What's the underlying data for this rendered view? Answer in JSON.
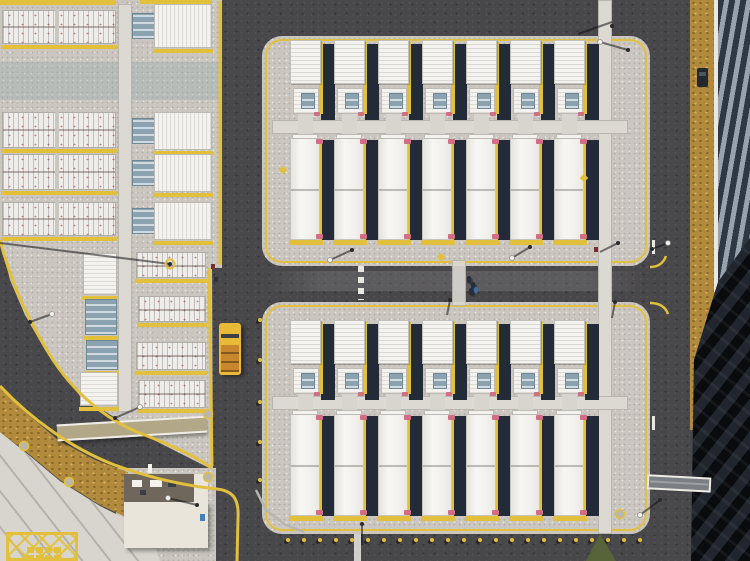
{
  "scene": {
    "description": "Aerial top-down drone photo of a battery energy storage facility: two large concrete pads with seven rows of white battery containers each, yellow curbs, asphalt access roads, a small service building, dirt strips, a yellow service truck, workers on the road, and a dark ribbed structure with a long shadow on the right edge",
    "colors": {
      "curb": "#e2c03c",
      "asphalt": "#48474a",
      "concrete": "#cbc7c0",
      "walkway": "#dcd9d2",
      "container_white": "#f4f3f0",
      "shadow_navy": "#232b38",
      "unit_blue": "#8ba3b0",
      "pink_cap": "#cf6e84",
      "dirt": "#b18a3e",
      "sidewalk": "#d8d5ce",
      "dark_zone": "#16191f",
      "building_roof": "#6f675c",
      "building_body": "#e9e5da",
      "truck_yellow": "#e9b938",
      "truck_bed": "#c8872f",
      "grass": "#57643a",
      "canopy_tan": "#b2a888",
      "white_line": "#e9e7e1"
    },
    "pads": [
      {
        "id": "upper-pad",
        "x": 262,
        "y": 36,
        "w": 388,
        "h": 230,
        "bigY": 40,
        "smallY": 88,
        "walkY": 120,
        "longY": 138
      },
      {
        "id": "lower-pad",
        "x": 262,
        "y": 302,
        "w": 388,
        "h": 232,
        "bigY": 320,
        "smallY": 368,
        "walkY": 396,
        "longY": 414
      }
    ],
    "columns": {
      "count": 7,
      "pitch": 44,
      "x0": 290,
      "white_w": 31,
      "big_h": 44,
      "small_h": 26,
      "long_h": 102
    },
    "left_section": {
      "rack_rows": [
        [
          2,
          10,
          114,
          34
        ],
        [
          2,
          112,
          114,
          36
        ],
        [
          2,
          154,
          114,
          36
        ],
        [
          2,
          202,
          114,
          34
        ]
      ],
      "mid_rows": [
        [
          132,
          4,
          80,
          44
        ],
        [
          132,
          112,
          80,
          38
        ],
        [
          132,
          154,
          80,
          38
        ],
        [
          132,
          202,
          80,
          38
        ]
      ],
      "small_units": [
        [
          83,
          253,
          34,
          42,
          "white"
        ],
        [
          85,
          299,
          32,
          36,
          "blue"
        ],
        [
          86,
          340,
          32,
          30,
          "blue"
        ],
        [
          80,
          372,
          38,
          34,
          "white"
        ]
      ],
      "lower_racks": [
        [
          136,
          252,
          70,
          26
        ],
        [
          138,
          296,
          68,
          26
        ],
        [
          136,
          342,
          70,
          28
        ],
        [
          138,
          380,
          68,
          28
        ]
      ]
    },
    "bollards_bottom": {
      "y": 538,
      "x0": 286,
      "pitch": 16,
      "count": 23
    },
    "bollards_left": [
      [
        258,
        318
      ],
      [
        258,
        358
      ],
      [
        258,
        400
      ],
      [
        258,
        440
      ],
      [
        258,
        478
      ]
    ],
    "people": [
      [
        467,
        276
      ],
      [
        471,
        282
      ],
      [
        469,
        288
      ]
    ],
    "worker_item_blue": [
      474,
      287
    ],
    "truck": {
      "x": 219,
      "y": 323,
      "w": 22,
      "h": 52
    },
    "car": {
      "x": 697,
      "y": 68,
      "w": 11,
      "h": 19
    },
    "poles": [
      {
        "s": [
          0,
          243,
          170,
          264
        ],
        "b": [
          170,
          264
        ],
        "ring": true
      },
      {
        "s": [
          30,
          322,
          52,
          314
        ],
        "b": [
          30,
          322
        ],
        "lamp": [
          52,
          314
        ]
      },
      {
        "s": [
          352,
          250,
          330,
          260
        ],
        "b": [
          352,
          250
        ],
        "lamp": [
          330,
          260
        ]
      },
      {
        "s": [
          578,
          34,
          612,
          22
        ],
        "b": [
          612,
          26
        ]
      },
      {
        "s": [
          628,
          50,
          600,
          42
        ],
        "b": [
          628,
          50
        ],
        "lamp": [
          600,
          42
        ]
      },
      {
        "s": [
          652,
          249,
          668,
          243
        ],
        "b": [
          652,
          249
        ],
        "lamp": [
          668,
          243
        ]
      },
      {
        "s": [
          530,
          247,
          512,
          258
        ],
        "b": [
          530,
          247
        ],
        "lamp": [
          512,
          258
        ]
      },
      {
        "s": [
          618,
          243,
          600,
          252
        ],
        "b": [
          618,
          243
        ]
      },
      {
        "s": [
          450,
          300,
          447,
          315
        ],
        "b": [
          450,
          300
        ]
      },
      {
        "s": [
          615,
          302,
          612,
          318
        ],
        "b": [
          615,
          302
        ]
      },
      {
        "s": [
          115,
          418,
          140,
          407
        ],
        "b": [
          115,
          418
        ],
        "lamp": [
          140,
          407
        ]
      },
      {
        "s": [
          197,
          505,
          168,
          498
        ],
        "b": [
          197,
          505
        ],
        "lamp": [
          168,
          498
        ]
      },
      {
        "s": [
          362,
          524,
          362,
          545
        ],
        "b": [
          362,
          524
        ]
      },
      {
        "s": [
          660,
          500,
          640,
          515
        ],
        "b": [
          660,
          500
        ],
        "lamp": [
          640,
          515
        ]
      }
    ],
    "manholes": [
      [
        24,
        446
      ],
      [
        69,
        482
      ],
      [
        208,
        477
      ],
      [
        208,
        414
      ],
      [
        620,
        514
      ]
    ],
    "diamond_markers": [
      [
        441,
        257
      ],
      [
        283,
        170
      ],
      [
        584,
        178
      ]
    ],
    "signs": [
      [
        211,
        264
      ],
      [
        214,
        277
      ],
      [
        594,
        247
      ]
    ],
    "hatch_squares": [
      [
        27,
        547
      ],
      [
        36,
        547
      ],
      [
        45,
        547
      ],
      [
        54,
        547
      ],
      [
        27,
        555
      ],
      [
        36,
        555
      ],
      [
        45,
        555
      ],
      [
        54,
        555
      ]
    ]
  }
}
